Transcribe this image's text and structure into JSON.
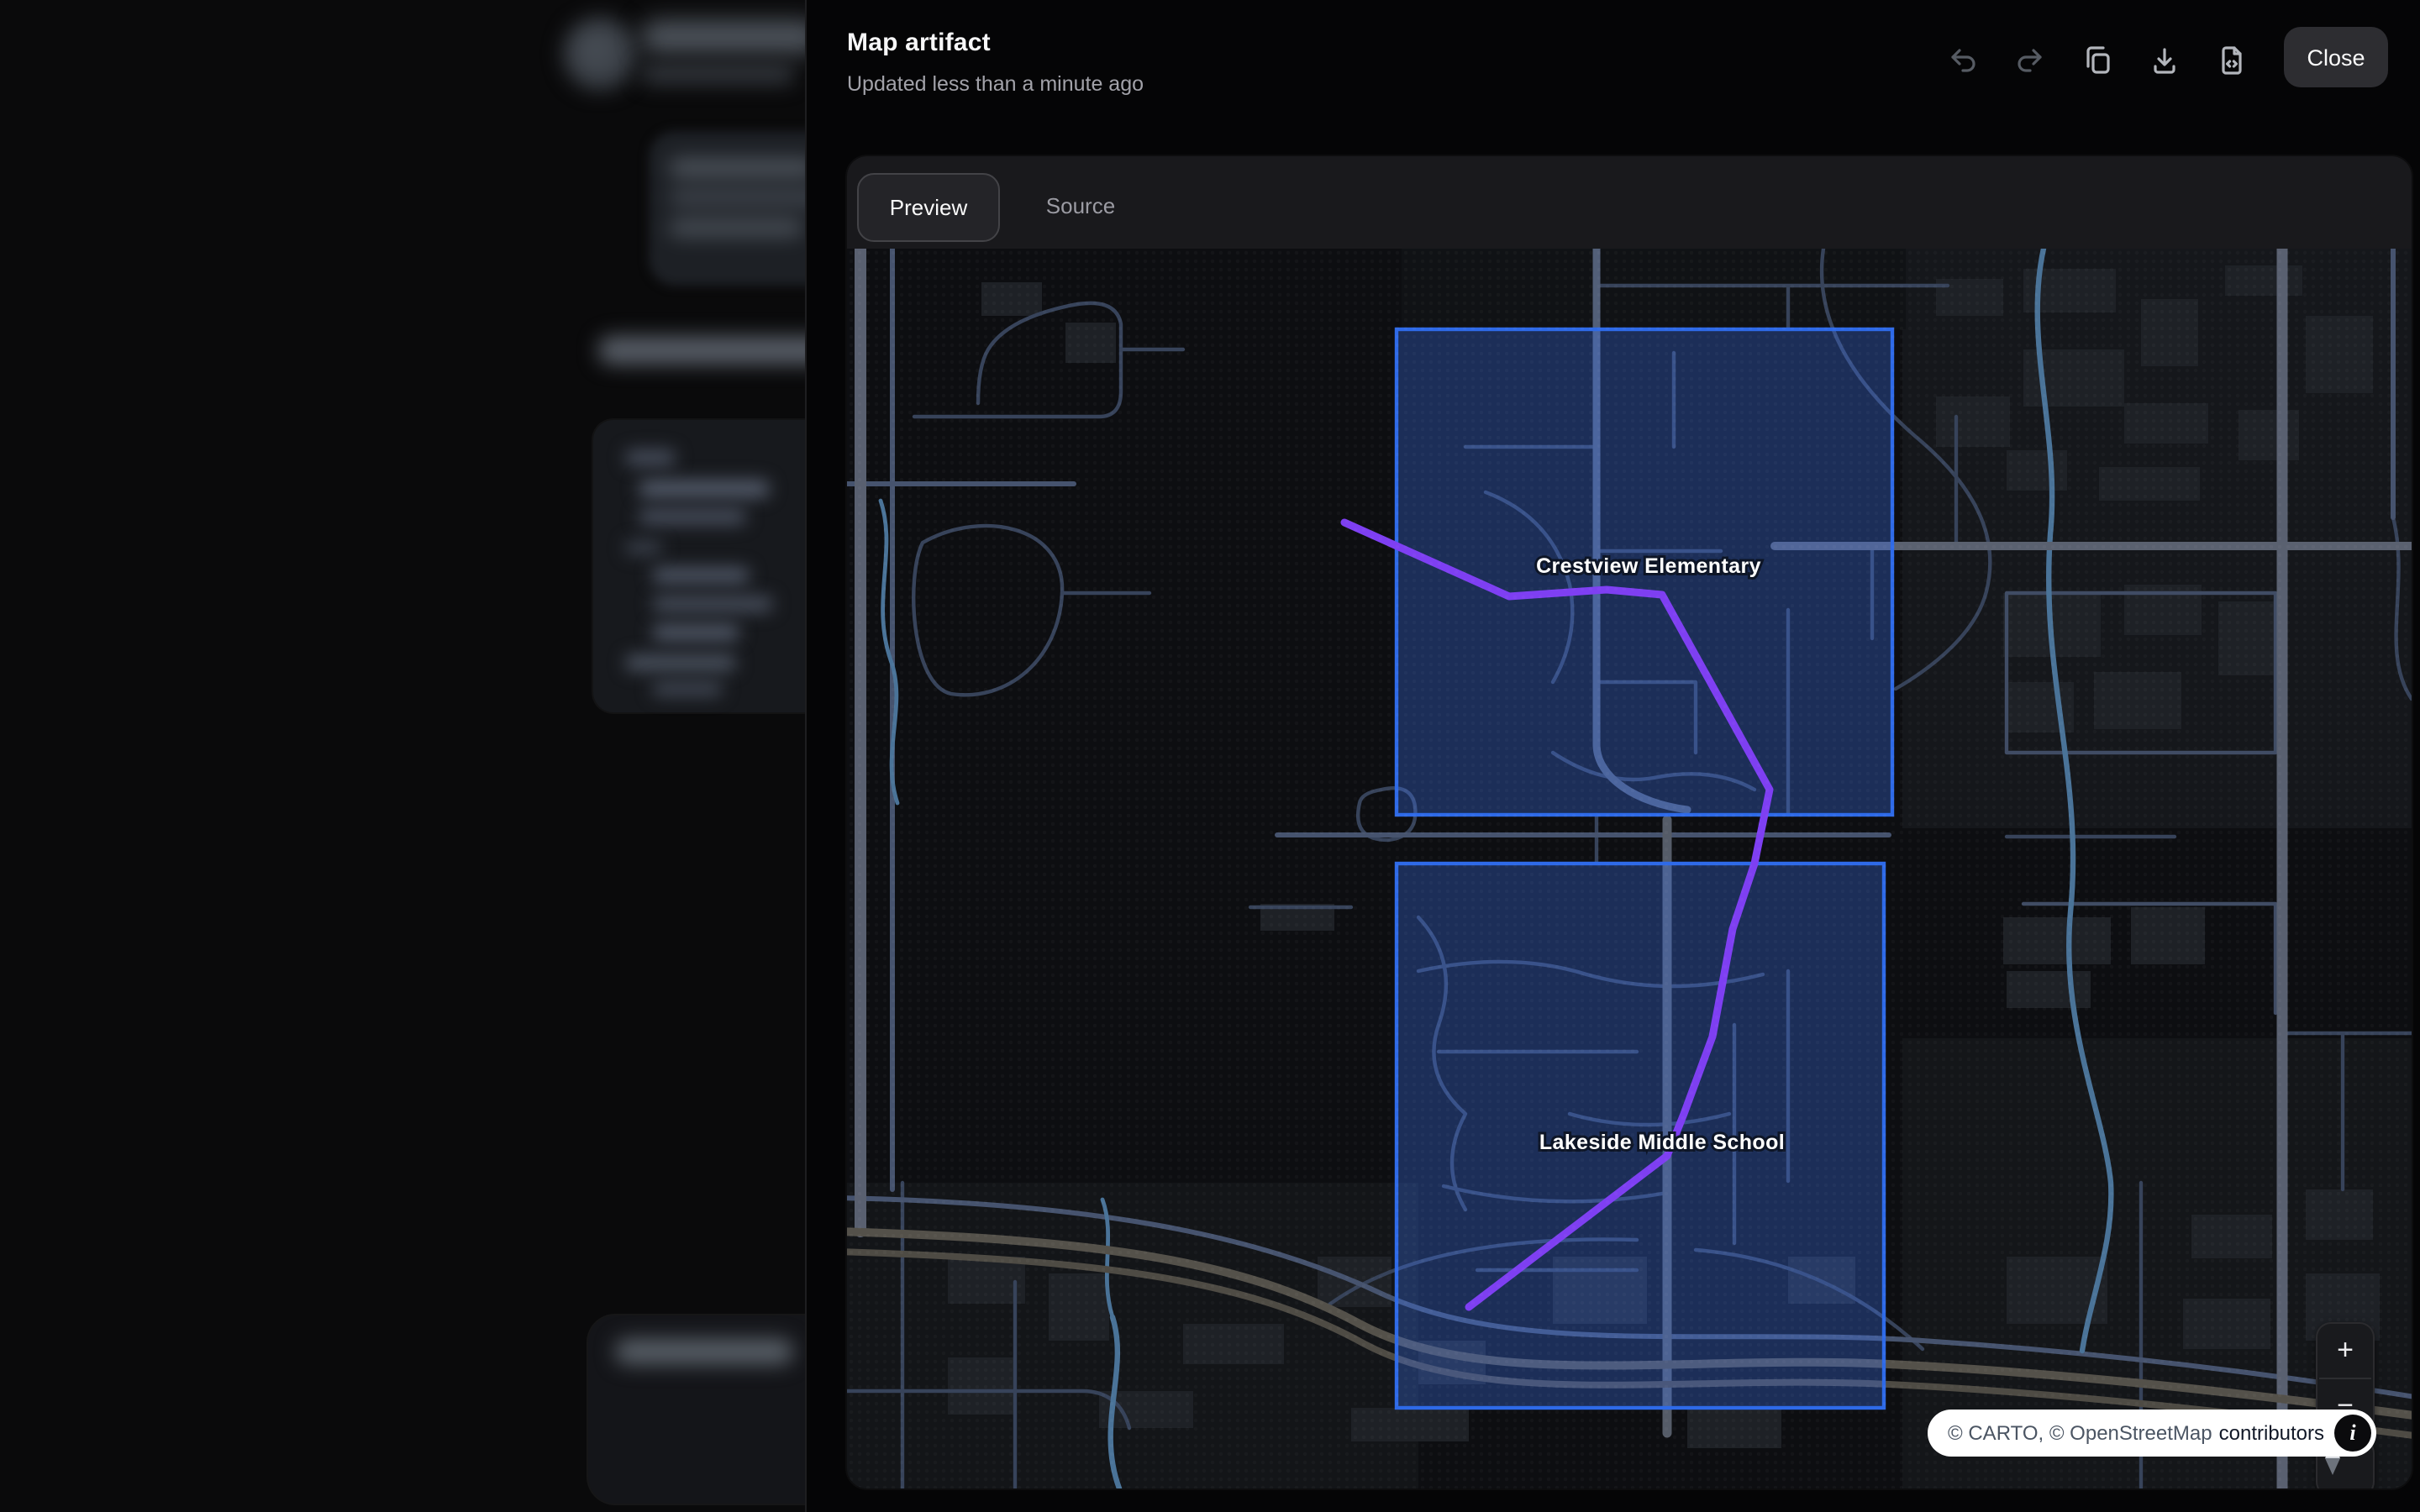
{
  "header": {
    "title": "Map artifact",
    "subtitle": "Updated less than a minute ago",
    "close_label": "Close",
    "tools": [
      "undo",
      "redo",
      "copy",
      "download",
      "file-code"
    ]
  },
  "tabs": {
    "preview": "Preview",
    "source": "Source",
    "active": "Preview"
  },
  "map": {
    "region_labels": {
      "crestview": "Crestview Elementary",
      "lakeside": "Lakeside Middle School"
    },
    "controls": {
      "zoom_in": "+",
      "zoom_out": "−",
      "info_glyph": "i"
    },
    "attribution": {
      "muted": "© CARTO, © OpenStreetMap",
      "strong": "contributors"
    },
    "colors": {
      "selection_fill": "#3d74f0",
      "selection_stroke": "#2e6ae8",
      "route": "#7e3ff2",
      "water": "#4a7398",
      "road_major": "#5a6170",
      "highway": "#54514a",
      "background": "#0d0e11"
    }
  }
}
